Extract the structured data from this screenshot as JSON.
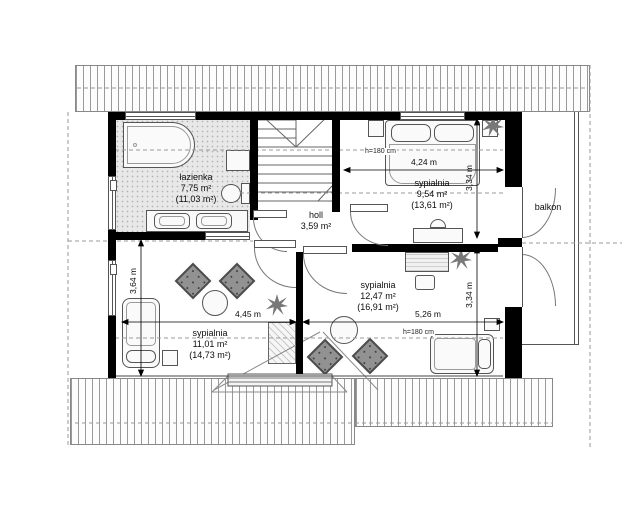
{
  "plan": {
    "rooms": {
      "bathroom": {
        "label": "łazienka",
        "area": "7,75 m²",
        "floor_area": "(11,03 m²)"
      },
      "hall": {
        "label": "holl",
        "area": "3,59 m²"
      },
      "bedroom_top": {
        "label": "sypialnia",
        "area": "9,54 m²",
        "floor_area": "(13,61 m²)"
      },
      "bedroom_right": {
        "label": "sypialnia",
        "area": "12,47 m²",
        "floor_area": "(16,91 m²)"
      },
      "bedroom_left": {
        "label": "sypialnia",
        "area": "11,01 m²",
        "floor_area": "(14,73 m²)"
      },
      "balcony": {
        "label": "balkon"
      }
    },
    "dims": {
      "top_width": "4,24 m",
      "top_height": "3,34 m",
      "right_height": "3,34 m",
      "right_width": "5,26 m",
      "left_width": "4,45 m",
      "left_height": "3,64 m",
      "knee_top": "h=180 cm",
      "knee_bottom": "h=180 cm"
    },
    "colors": {
      "wall": "#000000",
      "armchair": "#929292",
      "bathroom_floor": "#e8e8e8"
    }
  }
}
